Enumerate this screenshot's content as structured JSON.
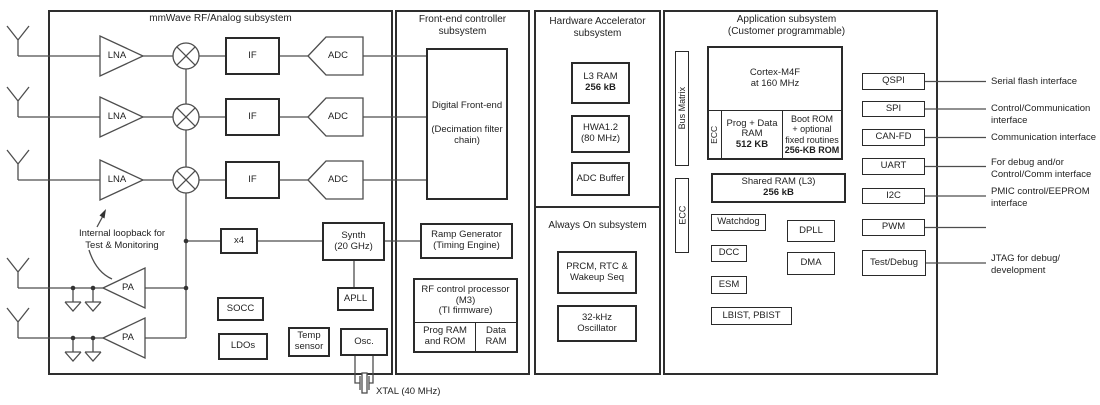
{
  "subsystems": {
    "mmwave_title": "mmWave RF/Analog subsystem",
    "frontend_title": [
      "Front-end controller",
      "subsystem"
    ],
    "hwaccel_title": [
      "Hardware Accelerator",
      "subsystem"
    ],
    "alwayson_title": "Always On subsystem",
    "app_title": [
      "Application subsystem",
      "(Customer programmable)"
    ]
  },
  "mm": {
    "lna": "LNA",
    "if": "IF",
    "adc": "ADC",
    "pa": "PA",
    "x4": "x4",
    "synth": [
      "Synth",
      "(20 GHz)"
    ],
    "apll": "APLL",
    "socc": "SOCC",
    "ldos": "LDOs",
    "temp": [
      "Temp",
      "sensor"
    ],
    "osc": "Osc.",
    "xtal": "XTAL (40 MHz)",
    "loopback": [
      "Internal loopback for",
      "Test & Monitoring"
    ]
  },
  "frontend": {
    "dfe": [
      "Digital Front-end",
      "(Decimation filter",
      "chain)"
    ],
    "ramp": [
      "Ramp Generator",
      "(Timing Engine)"
    ],
    "rfproc": [
      "RF control processor",
      "(M3)",
      "(TI firmware)"
    ],
    "prog_rom": [
      "Prog RAM",
      "and ROM"
    ],
    "data_ram": [
      "Data",
      "RAM"
    ]
  },
  "hwaccel": {
    "l3ram": [
      "L3 RAM",
      "256 kB"
    ],
    "hwa": [
      "HWA1.2",
      "(80 MHz)"
    ],
    "adcbuf": "ADC Buffer"
  },
  "alwayson": {
    "prcm": [
      "PRCM, RTC &",
      "Wakeup Seq"
    ],
    "osc32": [
      "32-kHz",
      "Oscillator"
    ]
  },
  "app": {
    "bus_matrix": "Bus Matrix",
    "ecc_left": "ECC",
    "cortex": [
      "Cortex-M4F",
      "at 160 MHz"
    ],
    "ecc_ram": "ECC",
    "prog_data": [
      "Prog + Data",
      "RAM",
      "512 KB"
    ],
    "bootrom": [
      "Boot ROM",
      "+ optional",
      "fixed routines",
      "256-KB ROM"
    ],
    "shared_ram": [
      "Shared RAM (L3)",
      "256 kB"
    ],
    "watchdog": "Watchdog",
    "dpll": "DPLL",
    "dcc": "DCC",
    "dma": "DMA",
    "esm": "ESM",
    "lbist": "LBIST, PBIST"
  },
  "peripherals": {
    "qspi": "QSPI",
    "spi": "SPI",
    "canfd": "CAN-FD",
    "uart": "UART",
    "i2c": "I2C",
    "pwm": "PWM",
    "testdebug": "Test/Debug"
  },
  "iface": {
    "qspi": [
      "Serial flash interface"
    ],
    "spi": [
      "Control/Communication",
      "interface"
    ],
    "canfd": [
      "Communication interface"
    ],
    "uart": [
      "For debug and/or",
      "Control/Comm interface"
    ],
    "i2c": [
      "PMIC control/EEPROM",
      "interface"
    ],
    "jtag": [
      "JTAG for debug/",
      "development"
    ]
  },
  "colors": {
    "line": "#4d4d4d",
    "border": "#2a2a2a",
    "text": "#1f1f1f",
    "background": "#ffffff"
  }
}
